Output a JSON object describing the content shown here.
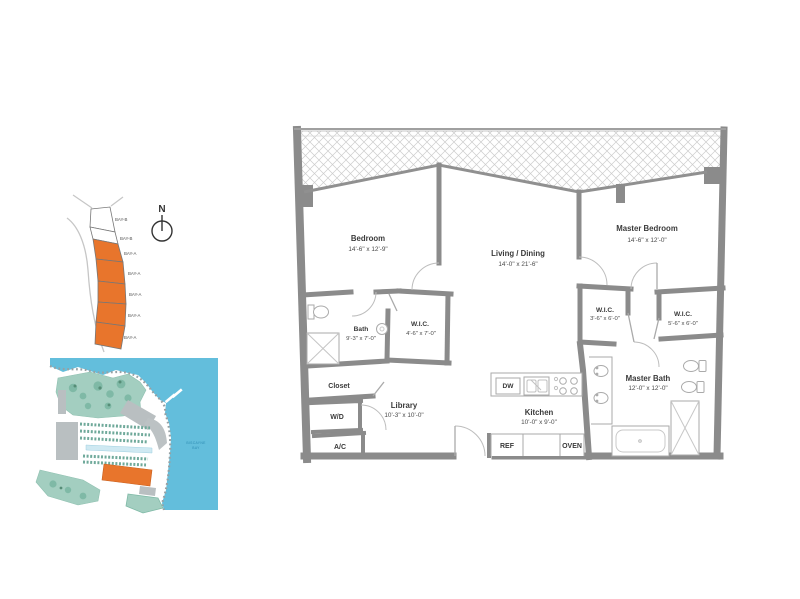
{
  "key_plan": {
    "bays": [
      {
        "label": "BAY-B",
        "highlighted": false
      },
      {
        "label": "BAY-B",
        "highlighted": false
      },
      {
        "label": "BAY-A",
        "highlighted": true
      },
      {
        "label": "BAY-A",
        "highlighted": true
      },
      {
        "label": "BAY-A",
        "highlighted": true
      },
      {
        "label": "BAY-A",
        "highlighted": true
      },
      {
        "label": "BAY-A",
        "highlighted": true
      }
    ],
    "highlight_color": "#E8752C",
    "compass": {
      "north_label": "N"
    }
  },
  "site_map": {
    "water_label_line1": "BISCAYNE",
    "water_label_line2": "BAY",
    "colors": {
      "water": "#63BEDC",
      "park_green": "#A3CEC0",
      "building_gray": "#B9BFC1",
      "highlight_orange": "#E8752C"
    }
  },
  "floor_plan": {
    "wall_color": "#8B8B8B",
    "rooms": {
      "bedroom": {
        "name": "Bedroom",
        "dims": "14'-6\" x 12'-9\""
      },
      "living_dining": {
        "name": "Living / Dining",
        "dims": "14'-0\" x 21'-6\""
      },
      "master_bedroom": {
        "name": "Master Bedroom",
        "dims": "14'-6\" x 12'-0\""
      },
      "bath": {
        "name": "Bath",
        "dims": "9'-3\" x 7'-0\""
      },
      "wic_1": {
        "name": "W.I.C.",
        "dims": "4'-6\" x 7'-0\""
      },
      "closet": {
        "name": "Closet"
      },
      "washer_dryer": {
        "name": "W/D"
      },
      "ac": {
        "name": "A/C"
      },
      "library": {
        "name": "Library",
        "dims": "10'-3\" x 10'-0\""
      },
      "kitchen": {
        "name": "Kitchen",
        "dims": "10'-0\" x 9'-0\""
      },
      "wic_2": {
        "name": "W.I.C.",
        "dims": "3'-6\" x 6'-0\""
      },
      "wic_3": {
        "name": "W.I.C.",
        "dims": "5'-6\" x 6'-0\""
      },
      "master_bath": {
        "name": "Master Bath",
        "dims": "12'-0\" x 12'-0\""
      }
    },
    "appliances": {
      "dw": "DW",
      "ref": "REF",
      "oven": "OVEN"
    }
  }
}
